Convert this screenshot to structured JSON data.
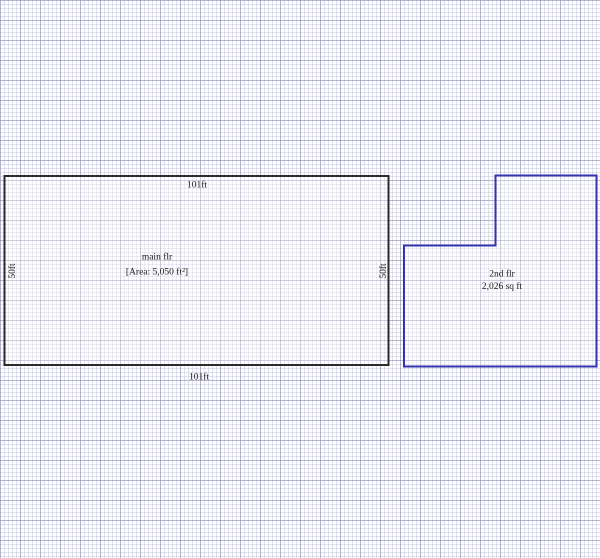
{
  "canvas": {
    "background_color": "#fdfdff",
    "grid_minor_color": "#e4e4f0",
    "grid_major_color": "#c8c8da"
  },
  "main_floor": {
    "name_label": "main flr",
    "area_label": "[Area: 5,050 ft²]",
    "dim_top": "101ft",
    "dim_bottom": "101ft",
    "dim_left": "50ft",
    "dim_right": "50ft",
    "stroke_color": "#2b2b2b"
  },
  "second_floor": {
    "name_label": "2nd flr",
    "area_label": "2,026 sq ft",
    "stroke_color": "#3434ae"
  }
}
